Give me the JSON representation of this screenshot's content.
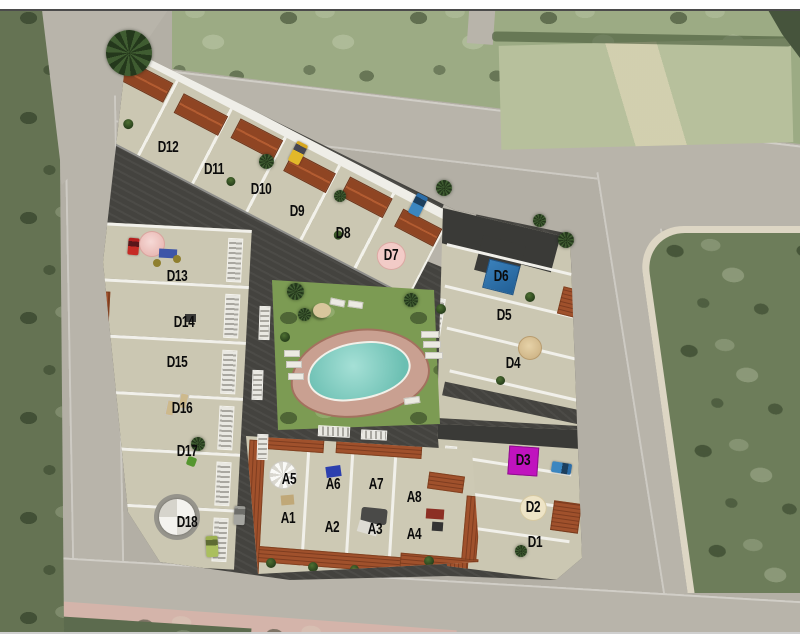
{
  "scene": {
    "description": "Aerial masterplan render of a residential development with numbered unit plots, communal pool and perimeter roads",
    "unit_labels": [
      {
        "id": "D12",
        "x": 168,
        "y": 148,
        "marker": "plain"
      },
      {
        "id": "D11",
        "x": 214,
        "y": 170,
        "marker": "plain"
      },
      {
        "id": "D10",
        "x": 261,
        "y": 190,
        "marker": "plain"
      },
      {
        "id": "D9",
        "x": 297,
        "y": 212,
        "marker": "plain"
      },
      {
        "id": "D8",
        "x": 343,
        "y": 234,
        "marker": "plain"
      },
      {
        "id": "D7",
        "x": 391,
        "y": 256,
        "marker": "pink-circle"
      },
      {
        "id": "D6",
        "x": 501,
        "y": 277,
        "marker": "blue-square"
      },
      {
        "id": "D5",
        "x": 504,
        "y": 316,
        "marker": "plain"
      },
      {
        "id": "D4",
        "x": 513,
        "y": 364,
        "marker": "plain"
      },
      {
        "id": "D3",
        "x": 523,
        "y": 461,
        "marker": "magenta-square"
      },
      {
        "id": "D2",
        "x": 533,
        "y": 508,
        "marker": "cream-circle"
      },
      {
        "id": "D1",
        "x": 535,
        "y": 543,
        "marker": "plain"
      },
      {
        "id": "D13",
        "x": 177,
        "y": 277,
        "marker": "plain"
      },
      {
        "id": "D14",
        "x": 184,
        "y": 323,
        "marker": "plain"
      },
      {
        "id": "D15",
        "x": 177,
        "y": 363,
        "marker": "plain"
      },
      {
        "id": "D16",
        "x": 182,
        "y": 409,
        "marker": "plain"
      },
      {
        "id": "D17",
        "x": 187,
        "y": 452,
        "marker": "plain"
      },
      {
        "id": "D18",
        "x": 187,
        "y": 523,
        "marker": "plain"
      },
      {
        "id": "A5",
        "x": 289,
        "y": 480,
        "marker": "plain"
      },
      {
        "id": "A6",
        "x": 333,
        "y": 485,
        "marker": "plain"
      },
      {
        "id": "A7",
        "x": 376,
        "y": 485,
        "marker": "plain"
      },
      {
        "id": "A8",
        "x": 414,
        "y": 498,
        "marker": "plain"
      },
      {
        "id": "A1",
        "x": 288,
        "y": 519,
        "marker": "plain"
      },
      {
        "id": "A2",
        "x": 332,
        "y": 528,
        "marker": "plain"
      },
      {
        "id": "A3",
        "x": 375,
        "y": 530,
        "marker": "plain"
      },
      {
        "id": "A4",
        "x": 414,
        "y": 535,
        "marker": "plain"
      }
    ],
    "colors": {
      "road": "#b8b4aa",
      "field_dark": "#6d7d5a",
      "field_light": "#9cab84",
      "walkway": "#44433f",
      "terrace": "#cbc7b2",
      "wall_white": "#f1f0ea",
      "roof_terracotta": "#a0512c",
      "dark_roof": "#3a3a37",
      "lawn": "#7c9b53",
      "pool_water": "#7fd0c3",
      "pool_deck": "#c9a091",
      "marker_blue": "#215f96",
      "marker_magenta": "#c013be",
      "marker_pink": "#f2cbc7",
      "marker_cream": "#eee4c6",
      "sidewalk_pink": "#d4b4aa",
      "car_yellow": "#e2b82a",
      "car_blue": "#2b6da8",
      "car_red": "#c62b25",
      "car_green": "#aabf5e"
    }
  }
}
